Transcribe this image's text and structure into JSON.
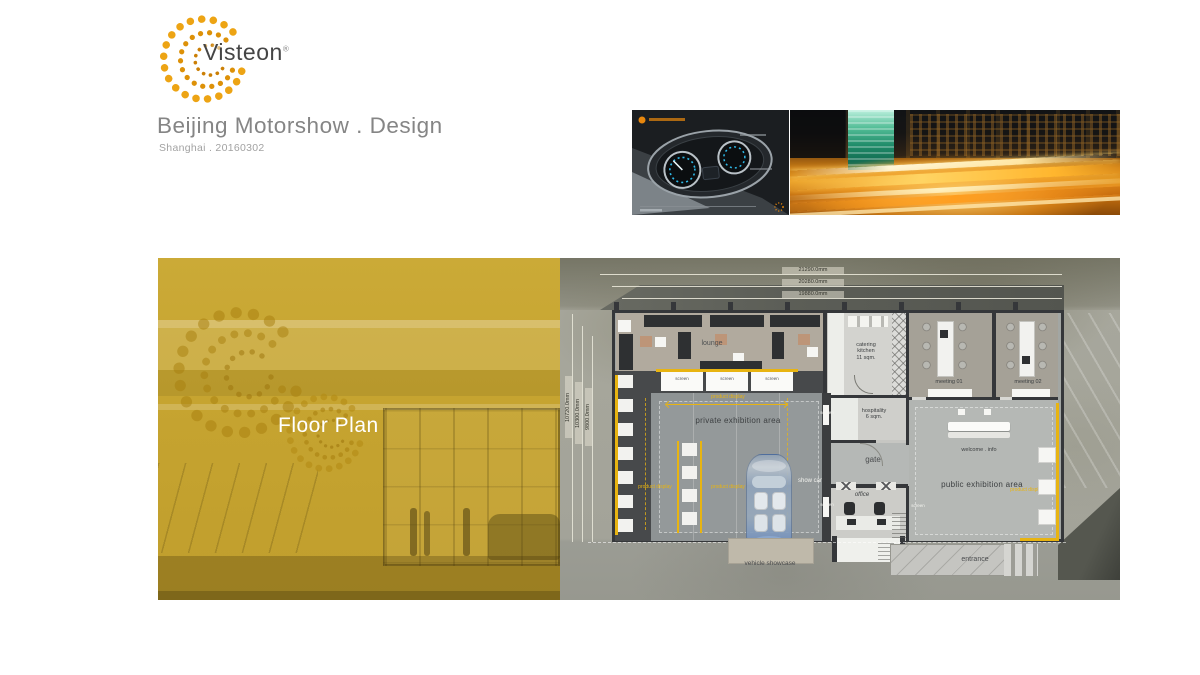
{
  "header": {
    "logo": {
      "brand": "Visteon",
      "registered_mark": "®"
    },
    "title": "Beijing Motorshow . Design",
    "subtitle": "Shanghai . 20160302"
  },
  "cover": {
    "section_label": "Floor Plan"
  },
  "floor_plan": {
    "dimensions": {
      "top": [
        "21290.0mm",
        "20280.0mm",
        "19880.0mm"
      ],
      "left": [
        "10720.0mm",
        "10300.0mm",
        "9800.0mm"
      ]
    },
    "labels": {
      "lounge": "lounge",
      "screen": "screen",
      "product_display": "product display",
      "private_exhibition_area": "private exhibition area",
      "public_exhibition_area": "public exhibition area",
      "catering_kitchen": "catering\nkitchen\n11 sqm.",
      "hospitality": "hospitality\n6 sqm.",
      "gate": "gate",
      "office": "office",
      "meeting_01": "meeting 01",
      "meeting_02": "meeting 02",
      "welcome_info": "welcome . info",
      "show_car": "show car",
      "vehicle_showcase": "vehicle showcase",
      "entrance": "entrance"
    },
    "colors": {
      "accent_yellow": "#E8B411",
      "wall_dark": "#35373A"
    }
  },
  "theme": {
    "brand_orange": "#E8A31A",
    "cover_gold": "#C7A42E",
    "title_gray": "#858585"
  }
}
